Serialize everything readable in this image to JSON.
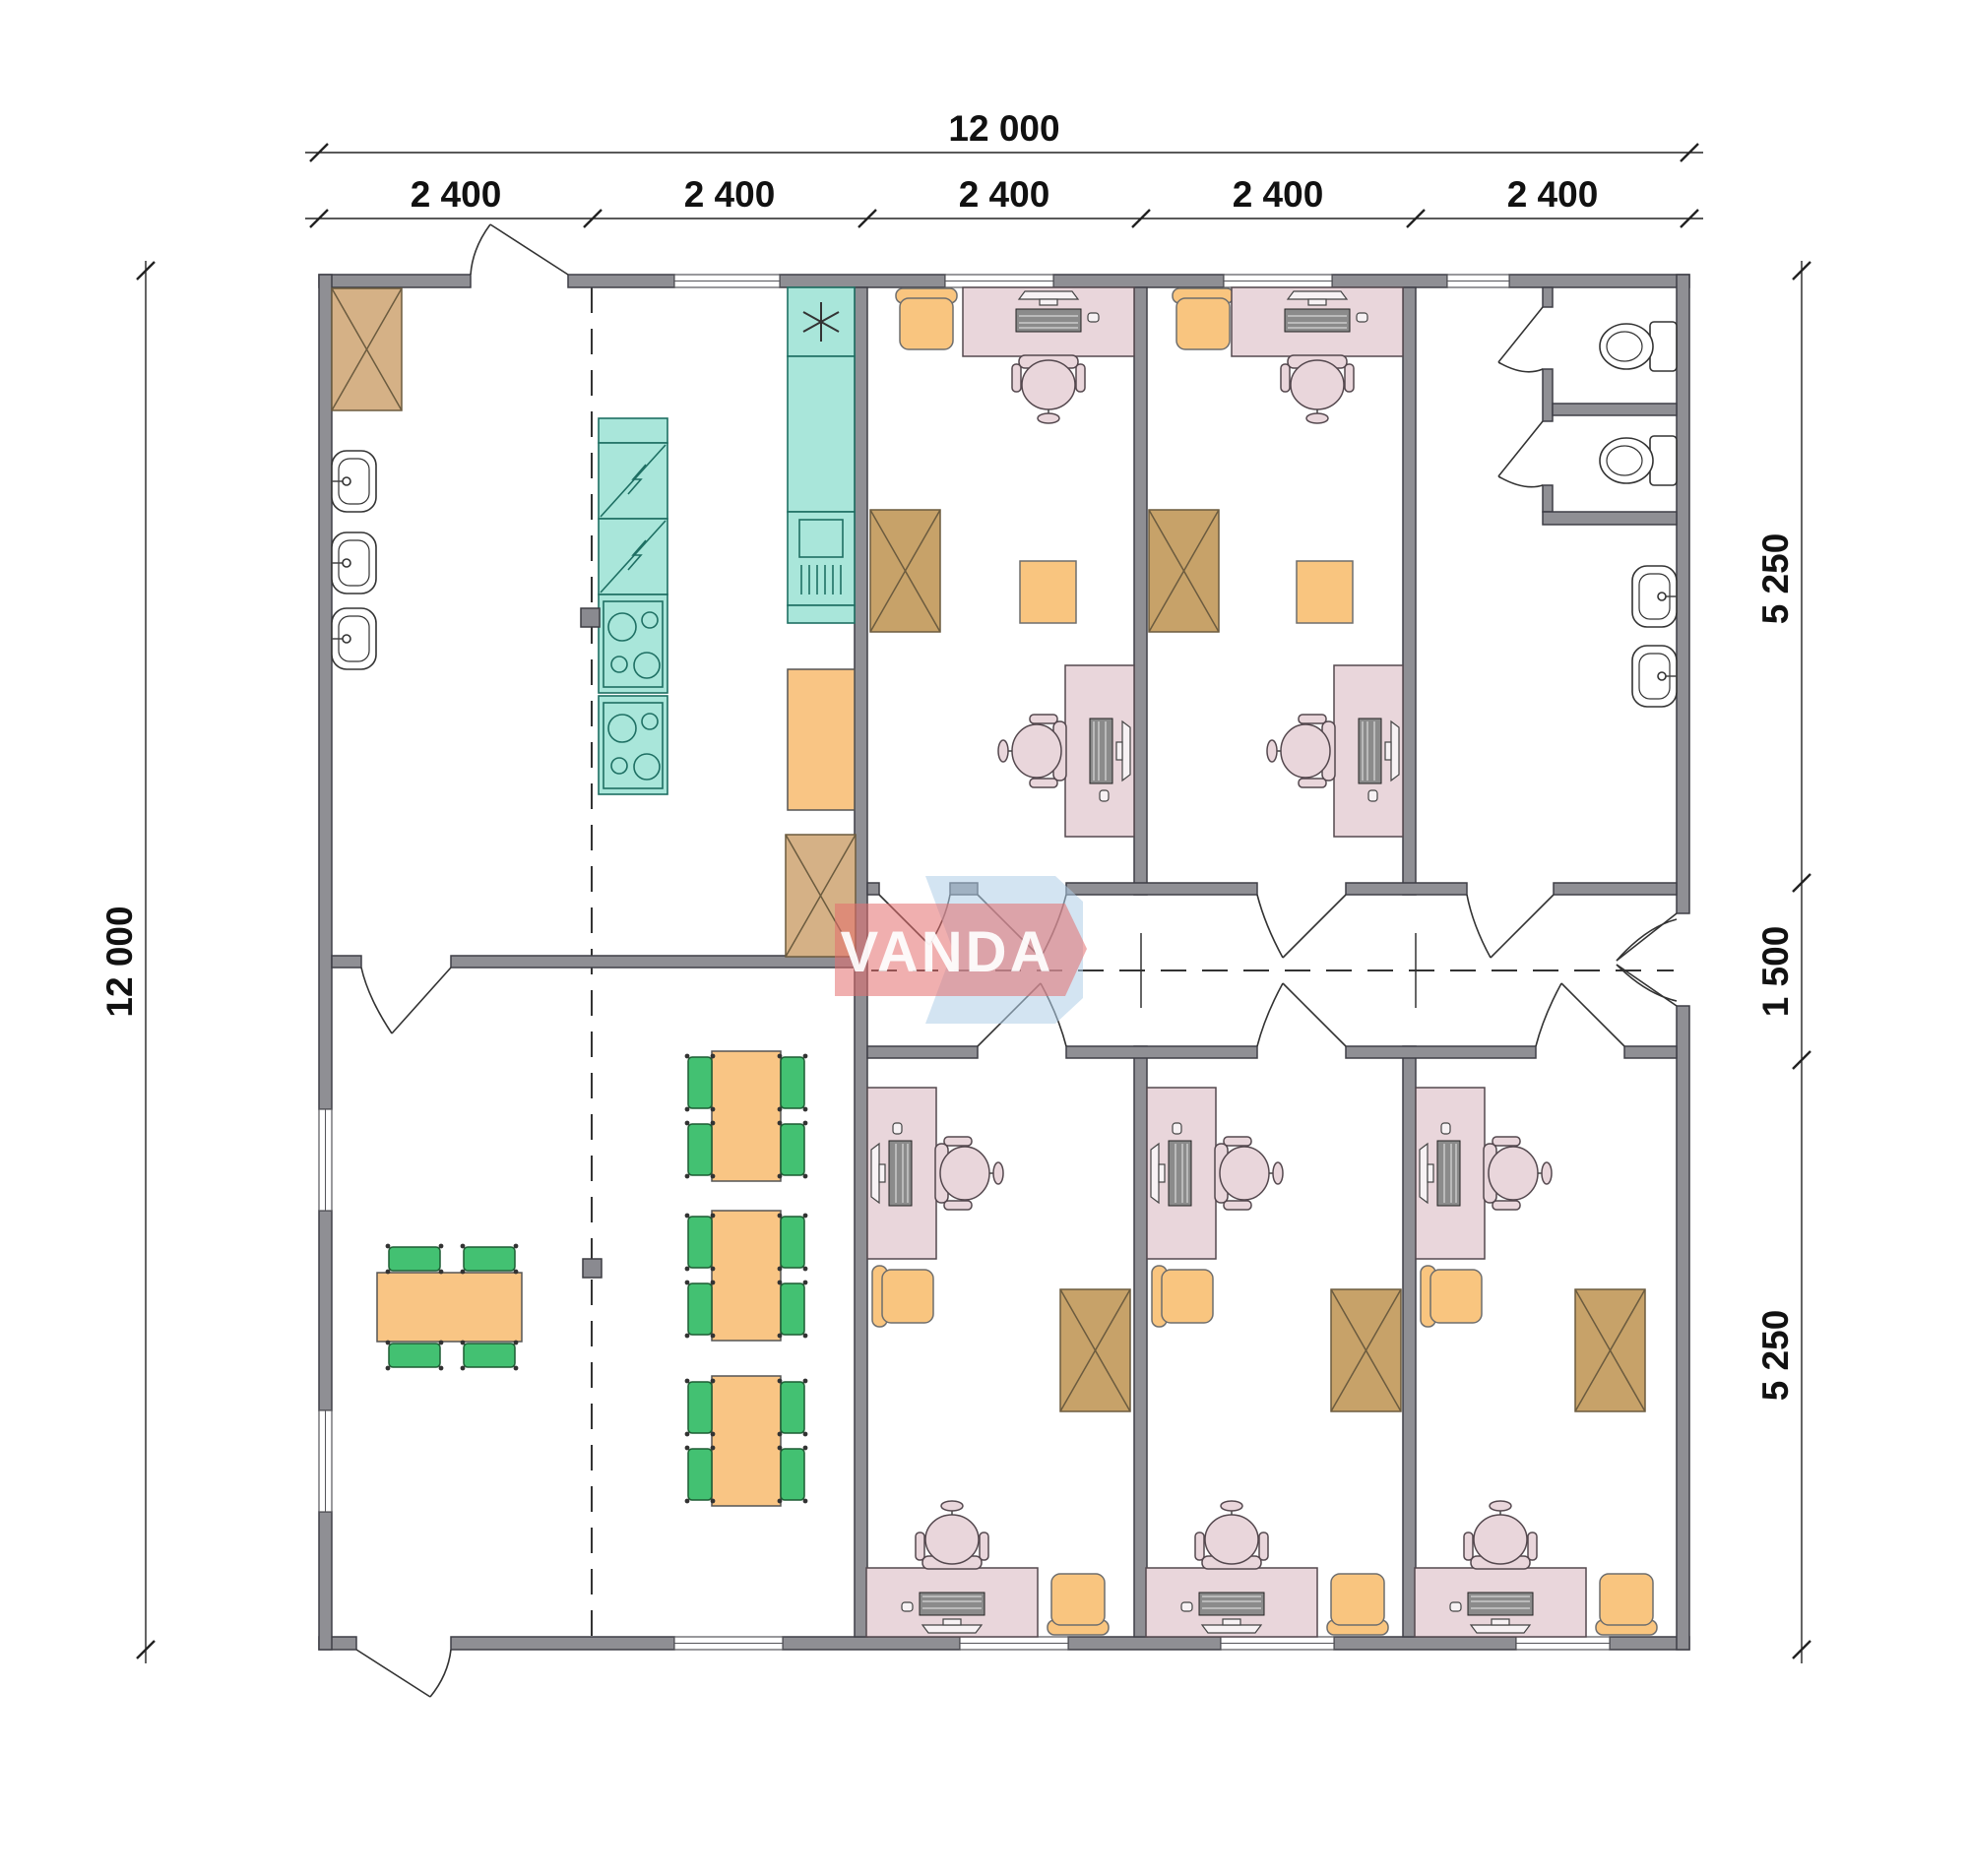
{
  "logo": {
    "text": "VANDA"
  },
  "dimensions": {
    "top_total": "12 000",
    "top_modules": [
      "2 400",
      "2 400",
      "2 400",
      "2 400",
      "2 400"
    ],
    "left_total": "12 000",
    "right_top": "5 250",
    "right_middle": "1 500",
    "right_bottom": "5 250"
  },
  "colors": {
    "wall": "#8f8f94",
    "wall-stroke": "#3f3f46",
    "wardrobe": "#d5b186",
    "wardrobe-dark": "#c7a269",
    "kitchen": "#a9e6da",
    "kitchen-stroke": "#1e6f63",
    "desk": "#e9d6db",
    "desk-stroke": "#54484e",
    "orange": "#f9c57f",
    "table": "#f9c584",
    "green": "#43c172",
    "green-stroke": "#1d5c33",
    "column": "#8a8a90",
    "line": "#333333",
    "logo-red": "#e46e6e",
    "logo-blue": "#aecde8",
    "logo-text": "#ffffff"
  }
}
